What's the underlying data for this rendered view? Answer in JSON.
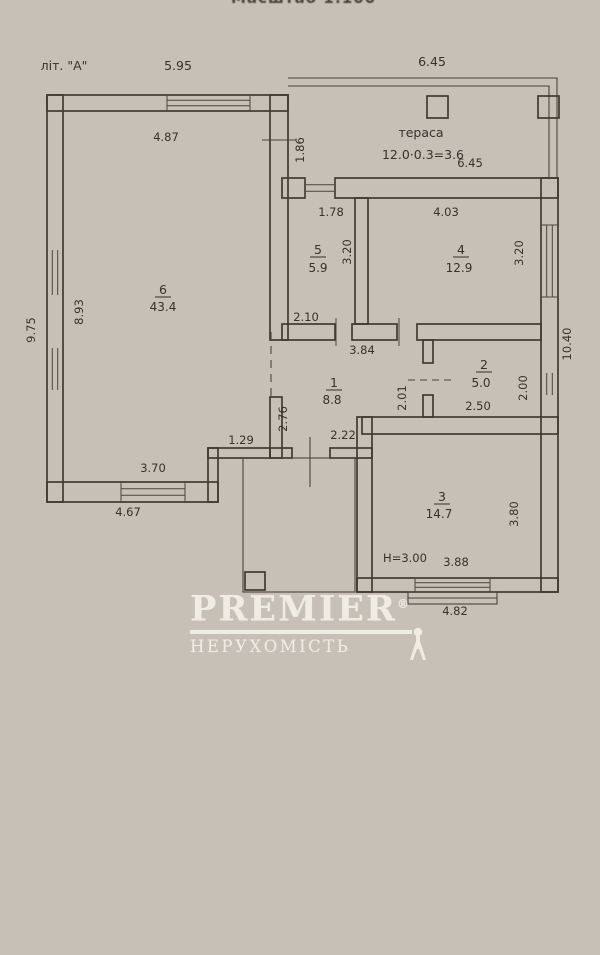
{
  "meta": {
    "scale_note": "Масштаб 1:100"
  },
  "plan": {
    "building_label": "літ. \"А\"",
    "terrace_label": "тераса",
    "terrace_area_formula": "12.0·0.3=3.6",
    "height_note": "Н=3.00",
    "rooms": [
      {
        "number": "1",
        "area": "8.8"
      },
      {
        "number": "2",
        "area": "5.0"
      },
      {
        "number": "3",
        "area": "14.7"
      },
      {
        "number": "4",
        "area": "12.9"
      },
      {
        "number": "5",
        "area": "5.9"
      },
      {
        "number": "6",
        "area": "43.4"
      }
    ],
    "dims": {
      "top_width_left": "5.95",
      "top_width_terrace": "6.45",
      "terrace_width_inner": "6.45",
      "terrace_depth": "1.86",
      "room5_width": "1.78",
      "room5_depth": "3.20",
      "room5_bottom": "2.10",
      "room4_width": "4.03",
      "room4_depth": "3.20",
      "hall_top": "3.84",
      "hall_door": "2.01",
      "hall_left": "2.76",
      "hall_bottom": "2.22",
      "room2_height": "2.00",
      "room2_bottom": "2.50",
      "room6_width": "4.87",
      "room6_height": "8.93",
      "room6_bottom": "3.70",
      "outer_left": "9.75",
      "outer_bottom_left": "4.67",
      "step": "1.29",
      "room3_bottom": "3.88",
      "room3_height": "3.80",
      "outer_bottom_right": "4.82",
      "outer_right": "10.40"
    }
  },
  "watermark": {
    "brand": "PREMIER",
    "registered": "®",
    "subtitle": "НЕРУХОМІСТЬ"
  },
  "colors": {
    "paper": "#c6c0b6",
    "ink": "#403a31",
    "watermark_text": "#f2efe7"
  }
}
